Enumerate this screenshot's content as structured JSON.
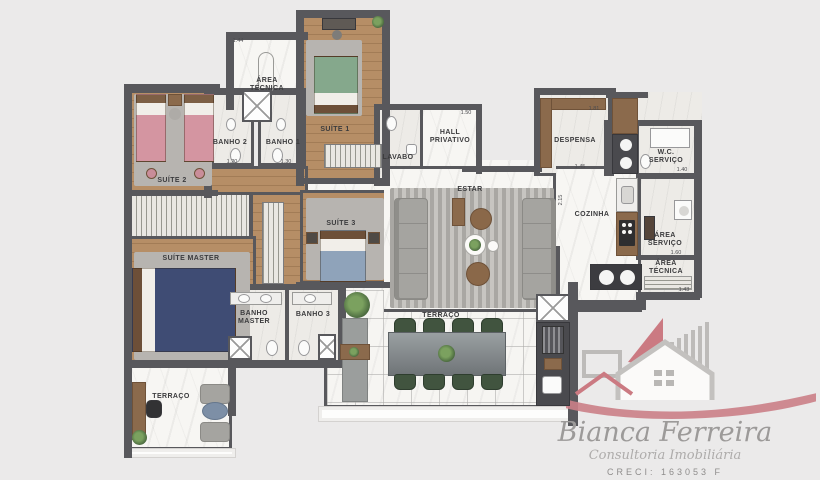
{
  "plan": {
    "rooms": {
      "area_tecnica_top": {
        "label": "ÁREA TÉCNICA"
      },
      "suite_1": {
        "label": "SUÍTE 1"
      },
      "banho_2": {
        "label": "BANHO 2"
      },
      "banho_1": {
        "label": "BANHO 1"
      },
      "suite_2": {
        "label": "SUÍTE 2"
      },
      "lavabo": {
        "label": "LAVABO"
      },
      "hall_privativo": {
        "label": "HALL PRIVATIVO"
      },
      "despensa": {
        "label": "DESPENSA"
      },
      "wc_servico": {
        "label": "W.C. SERVIÇO"
      },
      "estar": {
        "label": "ESTAR"
      },
      "cozinha": {
        "label": "COZINHA"
      },
      "area_servico": {
        "label": "ÁREA SERVIÇO"
      },
      "area_tecnica_dir": {
        "label": "ÁREA TÉCNICA"
      },
      "suite_master": {
        "label": "SUÍTE MASTER"
      },
      "suite_3": {
        "label": "SUÍTE 3"
      },
      "banho_master": {
        "label": "BANHO MASTER"
      },
      "banho_3": {
        "label": "BANHO 3"
      },
      "terraco_escritorio": {
        "label": "TERRAÇO"
      },
      "terraco_gourmet": {
        "label": "TERRAÇO"
      }
    },
    "dimensions": {
      "area_tecnica_top": "1.44",
      "banho_2": "1.20",
      "banho_1": "1.30",
      "hall_privativo": "1.50",
      "despensa_top": "1.81",
      "despensa_bottom": "1.45",
      "wc_servico": "1.40",
      "cozinha": "2.15",
      "area_servico": "1.60",
      "area_tecnica_dir": "1.43"
    }
  },
  "branding": {
    "name": "Bianca Ferreira",
    "tagline": "Consultoria Imobiliária",
    "creci": "CRECI: 163053 F",
    "accent_color": "#cb7a82",
    "gray_color": "#bdbbb9"
  }
}
